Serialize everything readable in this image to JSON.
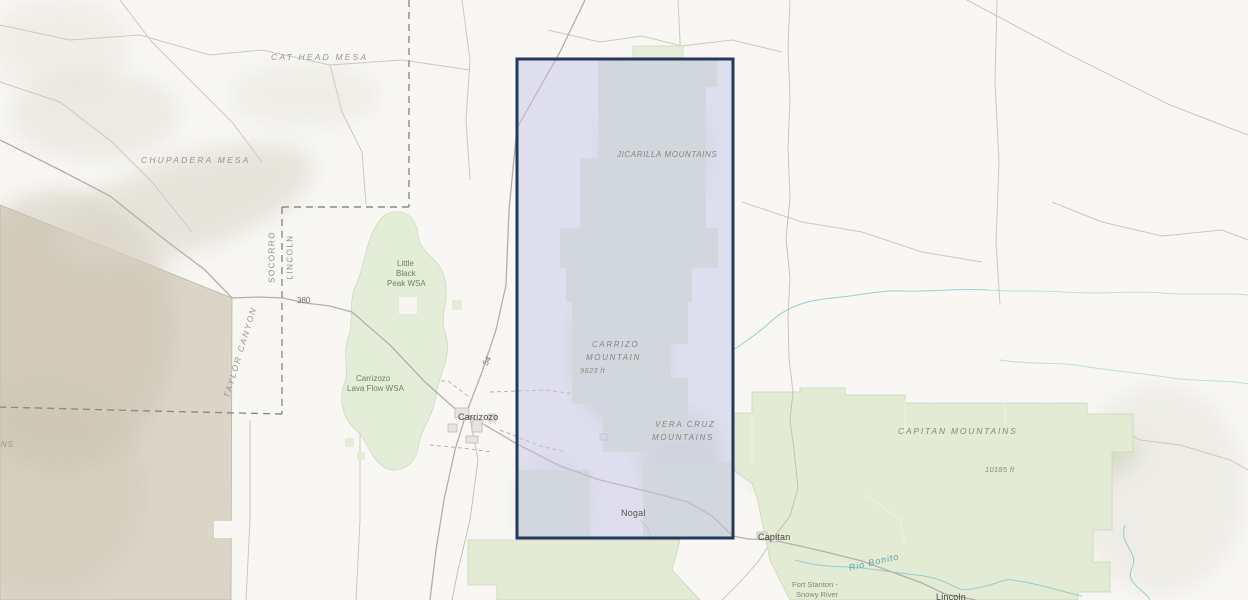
{
  "map": {
    "physiographic_labels": {
      "cat_head_mesa": "CAT HEAD MESA",
      "chupadera_mesa": "CHUPADERA MESA",
      "taylor_canyon": "TAYLOR CANYON",
      "mountains_partial": "MOUNTAINS",
      "jicarilla_mountains": "JICARILLA MOUNTAINS",
      "carrizo_mountain_line1": "CARRIZO",
      "carrizo_mountain_line2": "MOUNTAIN",
      "vera_cruz_line1": "VERA CRUZ",
      "vera_cruz_line2": "MOUNTAINS",
      "capitan_mountains": "CAPITAN MOUNTAINS"
    },
    "elevations": {
      "carrizo_peak": "9623 ft",
      "capitan_peak": "10185 ft"
    },
    "protected_areas": {
      "little_black_peak_l1": "Little",
      "little_black_peak_l2": "Black",
      "little_black_peak_l3": "Peak WSA",
      "carrizozo_lava_l1": "Carrizozo",
      "carrizozo_lava_l2": "Lava Flow WSA",
      "fort_stanton_l1": "Fort Stanton -",
      "fort_stanton_l2": "Snowy River"
    },
    "counties": {
      "west": "SOCORRO",
      "east": "LINCOLN"
    },
    "towns": {
      "carrizozo": "Carrizozo",
      "nogal": "Nogal",
      "capitan": "Capitan",
      "lincoln": "Lincoln"
    },
    "routes": {
      "us380": "380",
      "us54": "54"
    },
    "water": {
      "rio_bonito": "Rio Bonito"
    },
    "colors": {
      "selection_border": "#22395c",
      "selection_fill": "#c6c6ea",
      "forest_green": "#dfe7d0",
      "wsa_green": "#e4edd7",
      "military_tan": "#dbd5c8",
      "stream_teal": "#7fc0c6",
      "road_gray": "#b3afa8",
      "county_dash_gray": "#8b8b88"
    }
  }
}
